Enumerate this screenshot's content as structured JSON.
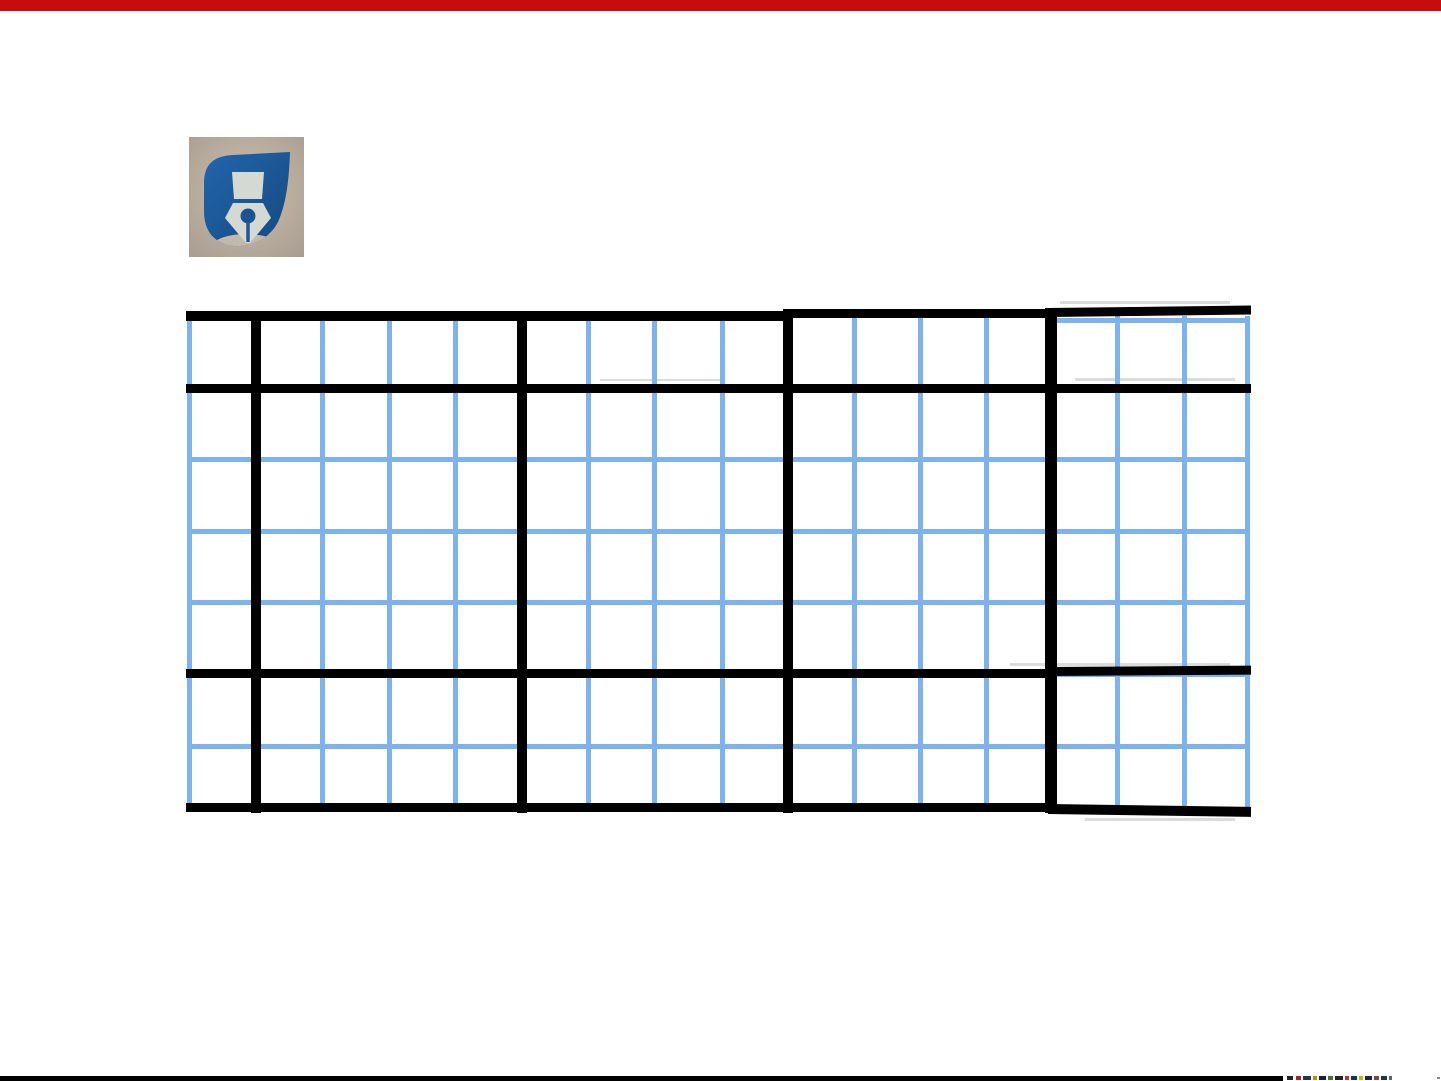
{
  "page": {
    "width": 1441,
    "height": 1081,
    "background": "#ffffff"
  },
  "top_bar": {
    "color": "#c50d0d",
    "height": 11
  },
  "logo": {
    "label": "pen-nib-logo",
    "x": 189,
    "y": 137,
    "width": 115,
    "height": 120,
    "photo_bg_center": "#cec0af",
    "photo_bg_edge": "#a79c90",
    "shape_color": "#2166ac",
    "shape_color_dark": "#16497f",
    "nib_color": "#d4d9d4",
    "hole_color": "#1b5491",
    "highlight_color": "#cbbfae"
  },
  "grid_table": {
    "blue_color": "#7db2ea",
    "black_color": "#000000",
    "smudge_color": "#bdbdbd",
    "blue_thickness": 5,
    "blue_verticals_x": [
      189,
      255,
      322,
      389,
      455,
      521,
      588,
      654,
      722,
      788,
      854,
      920,
      986,
      1051,
      1117,
      1184,
      1247
    ],
    "blue_v_y1": 316,
    "blue_v_y2": 810,
    "blue_h_x1": 187,
    "blue_h_x2": 1250,
    "blue_horizontals_y": [
      388,
      459,
      531,
      602,
      674,
      746
    ],
    "blue_top_segment": {
      "y": 320,
      "x1": 1052,
      "x2": 1250
    },
    "black_verticals": [
      {
        "x": 256,
        "w": 10,
        "y1": 312,
        "y2": 813
      },
      {
        "x": 522,
        "w": 10,
        "y1": 312,
        "y2": 813
      },
      {
        "x": 788,
        "w": 10,
        "y1": 309,
        "y2": 813
      },
      {
        "x": 1051,
        "w": 12,
        "y1": 308,
        "y2": 813
      }
    ],
    "black_horizontals": [
      {
        "x1": 186,
        "x2": 789,
        "y": 316,
        "t": 10,
        "rot": 0
      },
      {
        "x1": 783,
        "x2": 1055,
        "y": 313,
        "t": 9,
        "rot": 0
      },
      {
        "x1": 1048,
        "x2": 1251,
        "y": 312,
        "t": 9,
        "rot": -0.7
      },
      {
        "x1": 186,
        "x2": 1251,
        "y": 388,
        "t": 9,
        "rot": 0
      },
      {
        "x1": 186,
        "x2": 1050,
        "y": 673,
        "t": 9,
        "rot": 0
      },
      {
        "x1": 1046,
        "x2": 1251,
        "y": 671,
        "t": 9,
        "rot": -0.4
      },
      {
        "x1": 186,
        "x2": 1056,
        "y": 807,
        "t": 9,
        "rot": 0
      },
      {
        "x1": 1048,
        "x2": 1251,
        "y": 809,
        "t": 10,
        "rot": 0.8
      }
    ],
    "smudges": [
      {
        "x": 1060,
        "y": 301,
        "w": 170,
        "h": 3
      },
      {
        "x": 1075,
        "y": 378,
        "w": 160,
        "h": 3
      },
      {
        "x": 1010,
        "y": 663,
        "w": 220,
        "h": 3
      },
      {
        "x": 1085,
        "y": 818,
        "w": 150,
        "h": 3
      },
      {
        "x": 600,
        "y": 379,
        "w": 120,
        "h": 2
      }
    ]
  },
  "bottom_bar": {
    "color": "#000000",
    "x": 0,
    "y": 1076,
    "width": 1283,
    "height": 5
  },
  "bottom_fragment": {
    "y": 1076,
    "h": 4,
    "dashes": [
      {
        "x": 1287,
        "w": 6,
        "c": "#222233"
      },
      {
        "x": 1296,
        "w": 5,
        "c": "#aa2222"
      },
      {
        "x": 1303,
        "w": 8,
        "c": "#223355"
      },
      {
        "x": 1313,
        "w": 4,
        "c": "#cc8800"
      },
      {
        "x": 1319,
        "w": 7,
        "c": "#112244"
      },
      {
        "x": 1328,
        "w": 5,
        "c": "#447722"
      },
      {
        "x": 1335,
        "w": 8,
        "c": "#222222"
      },
      {
        "x": 1345,
        "w": 4,
        "c": "#bb3333"
      },
      {
        "x": 1351,
        "w": 6,
        "c": "#113366"
      },
      {
        "x": 1359,
        "w": 4,
        "c": "#ddaa00"
      },
      {
        "x": 1365,
        "w": 7,
        "c": "#222244"
      },
      {
        "x": 1374,
        "w": 5,
        "c": "#884444"
      },
      {
        "x": 1381,
        "w": 6,
        "c": "#223344"
      },
      {
        "x": 1389,
        "w": 3,
        "c": "#556677"
      }
    ],
    "dot": {
      "x": 1437,
      "y": 1077,
      "w": 3,
      "h": 2,
      "c": "#8a8a8a"
    }
  }
}
